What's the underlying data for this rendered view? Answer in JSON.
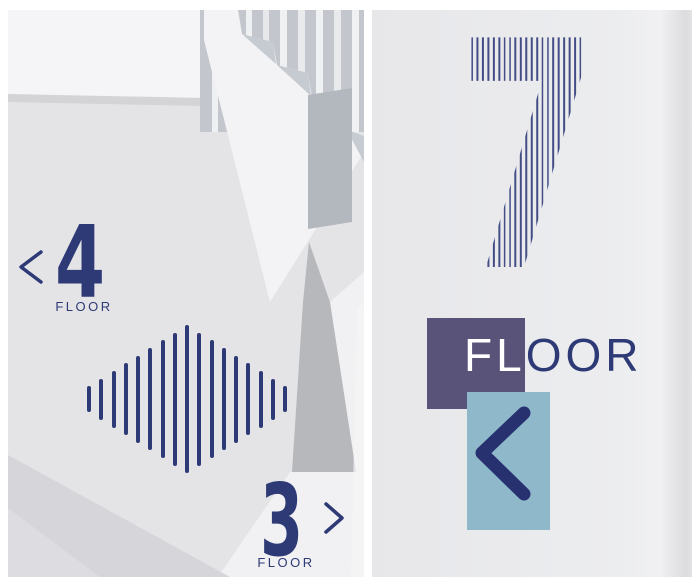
{
  "image_type": "photograph of stairwell wayfinding signage, two photos side by side",
  "colors": {
    "navy": "#2e3a76",
    "stripe_navy": "#424c85",
    "purple": "#5a5379",
    "light_blue": "#8fb9cb",
    "chevron_navy": "#283170",
    "wall_light": "#e9e9ec",
    "frame_white": "#ffffff"
  },
  "left_photo": {
    "description": "Stairwell with staircase, floor 4 and floor 3 signs and diamond stripe pattern",
    "floor4": {
      "number": "4",
      "label": "FLOOR",
      "chevron_direction": "left"
    },
    "floor3": {
      "number": "3",
      "label": "FLOOR",
      "chevron_direction": "right"
    },
    "diamond_pattern": {
      "bar_count": 17,
      "max_height": 148,
      "min_height": 26,
      "bar_width": 4
    }
  },
  "right_photo": {
    "description": "Wall with large striped floor number, purple square with FLOOR label and blue square with left chevron",
    "floor_number": "7",
    "floor_label": {
      "on_square": "FL",
      "off_square": "OOR"
    },
    "chevron_direction": "left"
  }
}
